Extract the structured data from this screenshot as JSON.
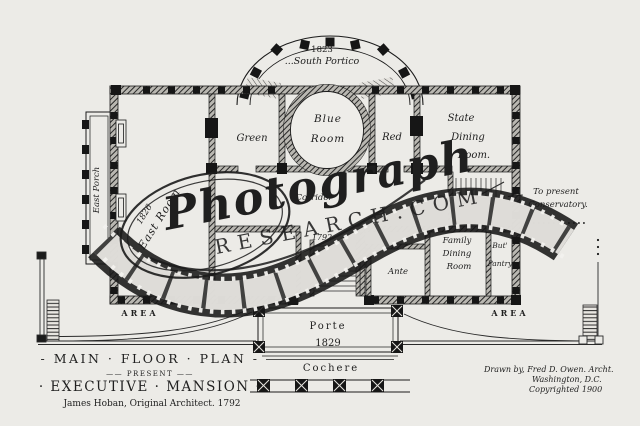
{
  "portico": {
    "year": "1823",
    "name": "...South Portico"
  },
  "rooms": {
    "blue_line1": "Blue",
    "blue_line2": "Room",
    "green": "Green",
    "red": "Red",
    "state_line1": "State",
    "state_line2": "Dining",
    "state_line3": "Room.",
    "east_year": "1826",
    "east": "East Room",
    "east_porch": "East Porch",
    "corridor": "Corridor",
    "hall_year": "1792",
    "ante": "Ante",
    "family_line1": "Family",
    "family_line2": "Dining",
    "family_line3": "Room",
    "pantry_line1": "But'",
    "pantry_line2": "Pantry"
  },
  "annotations": {
    "conservatory_line1": "To present",
    "conservatory_line2": "Conservatory.",
    "area_left": "AREA",
    "area_right": "AREA"
  },
  "north": {
    "porte": "Porte",
    "year": "1829",
    "cochere": "Cochere"
  },
  "title_block": {
    "line1": "- MAIN · FLOOR · PLAN -",
    "line2": "—— PRESENT ——",
    "line3": "· EXECUTIVE · MANSION ·",
    "line4": "James Hoban,  Original Architect.  1792"
  },
  "credits": {
    "line1": "Drawn by, Fred D. Owen. Archt.",
    "line2": "Washington, D.C.",
    "line3": "Copyrighted 1900"
  },
  "watermark": {
    "script": "Photograph",
    "domain": "RESEARCH.COM"
  },
  "colors": {
    "paper": "#ecebe7",
    "ink": "#1b1b1b"
  }
}
